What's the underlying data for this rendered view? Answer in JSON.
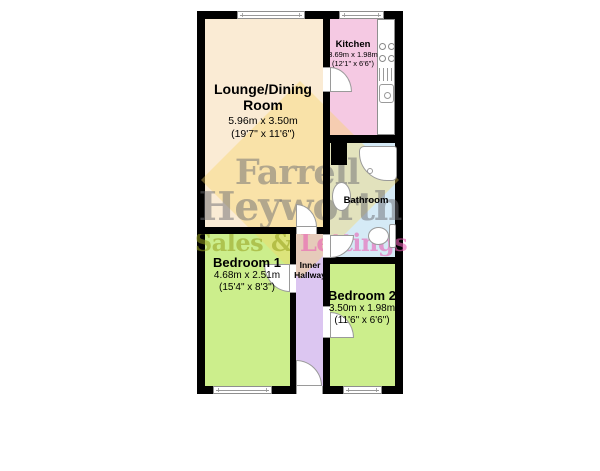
{
  "watermark": {
    "line1": "Farrell",
    "line2": "Heyworth",
    "tagline_left": "Sales & ",
    "tagline_right": "Lettings"
  },
  "rooms": {
    "lounge": {
      "name_line1": "Lounge/Dining",
      "name_line2": "Room",
      "dims_m": "5.96m x 3.50m",
      "dims_ft": "(19'7\" x 11'6\")"
    },
    "kitchen": {
      "name": "Kitchen",
      "dims_m": "3.69m x 1.98m",
      "dims_ft": "(12'1\" x 6'6\")"
    },
    "bathroom": {
      "name": "Bathroom"
    },
    "bedroom1": {
      "name": "Bedroom 1",
      "dims_m": "4.68m x 2.51m",
      "dims_ft": "(15'4\" x 8'3\")"
    },
    "bedroom2": {
      "name": "Bedroom 2",
      "dims_m": "3.50m x 1.98m",
      "dims_ft": "(11'6\" x 6'6\")"
    },
    "hallway": {
      "name_line1": "Inner",
      "name_line2": "Hallway"
    }
  },
  "palette": {
    "lounge": "#FAEBD4",
    "kitchen": "#F5C9E3",
    "bathroom": "#D5EAF6",
    "bedroom1": "#CCEE8C",
    "bedroom2": "#CCEE8C",
    "hallway": "#DCC6F1",
    "walls": "#000000",
    "watermark_text": "#A8A8AC",
    "watermark_sales": "#C9CC7E",
    "watermark_lettings": "#EFA9D2",
    "watermark_diamond": "#F7D660"
  }
}
